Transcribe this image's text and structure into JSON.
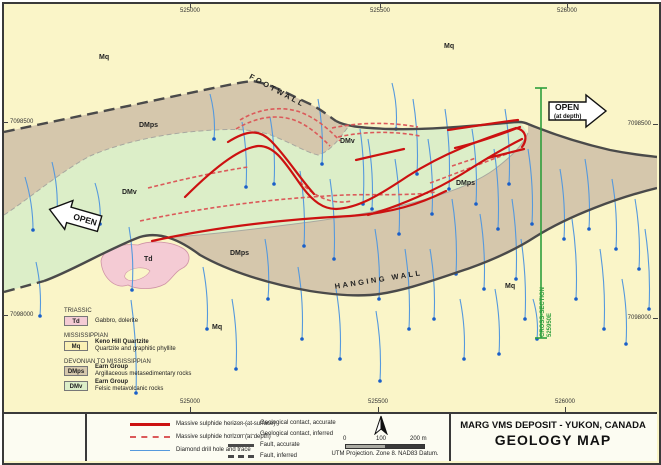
{
  "colors": {
    "mq": "#FAF5C8",
    "dmps": "#D5C7AC",
    "dmv": "#DCEEC8",
    "td": "#F4CBD4",
    "sulphide_red": "#CC1111",
    "sulphide_red_dashed": "#DB5A5A",
    "drill_blue": "#5599DD",
    "drill_dot_blue": "#1A5FC8",
    "fault_gray": "#4A4A4A",
    "contact_gray": "#A8A8A0",
    "section_green": "#2E9E3C"
  },
  "title_block": {
    "line1": "MARG VMS DEPOSIT - YUKON, CANADA",
    "line2": "GEOLOGY MAP"
  },
  "scale_bar": {
    "tick0": "0",
    "tick100": "100",
    "tick200": "200 m",
    "note": "UTM Projection. Zone 8. NAD83 Datum."
  },
  "line_legend": {
    "col1": [
      {
        "label": "Massive sulphide horizon (at surface)",
        "sym": "red-solid"
      },
      {
        "label": "Massive sulphide horizon (at depth)",
        "sym": "red-dashed"
      },
      {
        "label": "Diamond drill hole and trace",
        "sym": "blue-line"
      }
    ],
    "col2": [
      {
        "label": "Geological contact, accurate",
        "sym": "gray-line"
      },
      {
        "label": "Geological contact, inferred",
        "sym": "gray-dashed"
      },
      {
        "label": "Fault, accurate",
        "sym": "fault-line"
      },
      {
        "label": "Fault, inferred",
        "sym": "fault-dashed"
      }
    ]
  },
  "strat_legend": {
    "eras": [
      {
        "era": "TRIASSIC",
        "units": [
          {
            "code": "Td",
            "swatch": "td",
            "name": "",
            "desc": "Gabbro, dolerite"
          }
        ]
      },
      {
        "era": "MISSISSIPPIAN",
        "units": [
          {
            "code": "Mq",
            "swatch": "mq",
            "name": "Keno Hill Quartzite",
            "desc": "Quartzite and graphitic phyllite"
          }
        ]
      },
      {
        "era": "DEVONIAN TO MISSISSIPPIAN",
        "units": [
          {
            "code": "DMps",
            "swatch": "dmps",
            "name": "Earn Group",
            "desc": "Argillaceous metasedimentary rocks"
          },
          {
            "code": "DMv",
            "swatch": "dmv",
            "name": "Earn Group",
            "desc": "Felsic metavolcanic rocks"
          }
        ]
      }
    ]
  },
  "axis": {
    "top_eastings": [
      {
        "label": "525000",
        "x": 190
      },
      {
        "label": "525500",
        "x": 380
      },
      {
        "label": "526000",
        "x": 567
      }
    ],
    "bottom_eastings": [
      {
        "label": "525000",
        "x": 190
      },
      {
        "label": "525500",
        "x": 378
      },
      {
        "label": "526000",
        "x": 565
      }
    ],
    "left_northings": [
      {
        "label": "7098500",
        "y": 122
      },
      {
        "label": "7098000",
        "y": 315
      }
    ],
    "right_northings": [
      {
        "label": "7098500",
        "y": 124
      },
      {
        "label": "7098000",
        "y": 318
      }
    ]
  },
  "map_labels": [
    {
      "t": "Mq",
      "x": 99,
      "y": 54,
      "c": "unit"
    },
    {
      "t": "Mq",
      "x": 444,
      "y": 43,
      "c": "unit"
    },
    {
      "t": "Mq",
      "x": 212,
      "y": 324,
      "c": "unit"
    },
    {
      "t": "Mq",
      "x": 505,
      "y": 283,
      "c": "unit"
    },
    {
      "t": "DMps",
      "x": 139,
      "y": 122,
      "c": "unit"
    },
    {
      "t": "DMps",
      "x": 230,
      "y": 250,
      "c": "unit"
    },
    {
      "t": "DMps",
      "x": 456,
      "y": 180,
      "c": "unit"
    },
    {
      "t": "DMv",
      "x": 122,
      "y": 189,
      "c": "unit"
    },
    {
      "t": "DMv",
      "x": 340,
      "y": 138,
      "c": "unit"
    },
    {
      "t": "Td",
      "x": 144,
      "y": 256,
      "c": "unit"
    },
    {
      "t": "FOOTWALL",
      "x": 252,
      "y": 72,
      "r": 28,
      "c": "wall"
    },
    {
      "t": "HANGING WALL",
      "x": 334,
      "y": 282,
      "r": -9,
      "c": "wall"
    }
  ],
  "annotations": {
    "open_left": "OPEN",
    "open_right1": "OPEN",
    "open_right2": "(at depth)",
    "cross_section1": "CROSS-SECTION",
    "cross_section2": "525950E"
  },
  "drillholes": [
    [
      25,
      177,
      33,
      230
    ],
    [
      52,
      162,
      57,
      214
    ],
    [
      95,
      183,
      100,
      224
    ],
    [
      129,
      227,
      132,
      290
    ],
    [
      36,
      262,
      40,
      316
    ],
    [
      131,
      300,
      136,
      393
    ],
    [
      210,
      94,
      214,
      139
    ],
    [
      242,
      122,
      246,
      187
    ],
    [
      270,
      117,
      274,
      184
    ],
    [
      318,
      99,
      322,
      164
    ],
    [
      203,
      267,
      207,
      329
    ],
    [
      232,
      299,
      236,
      369
    ],
    [
      265,
      239,
      268,
      299
    ],
    [
      300,
      171,
      304,
      246
    ],
    [
      298,
      267,
      302,
      339
    ],
    [
      330,
      179,
      334,
      259
    ],
    [
      336,
      289,
      340,
      359
    ],
    [
      360,
      129,
      363,
      204
    ],
    [
      368,
      139,
      372,
      209
    ],
    [
      375,
      229,
      379,
      299
    ],
    [
      392,
      83,
      396,
      129
    ],
    [
      395,
      159,
      399,
      234
    ],
    [
      405,
      249,
      409,
      329
    ],
    [
      376,
      311,
      380,
      381
    ],
    [
      413,
      99,
      417,
      174
    ],
    [
      428,
      139,
      432,
      214
    ],
    [
      430,
      249,
      434,
      319
    ],
    [
      445,
      109,
      449,
      189
    ],
    [
      452,
      199,
      456,
      274
    ],
    [
      460,
      299,
      464,
      359
    ],
    [
      472,
      129,
      476,
      204
    ],
    [
      480,
      214,
      484,
      289
    ],
    [
      494,
      149,
      498,
      229
    ],
    [
      495,
      289,
      499,
      354
    ],
    [
      505,
      109,
      509,
      184
    ],
    [
      512,
      199,
      516,
      279
    ],
    [
      521,
      239,
      525,
      319
    ],
    [
      528,
      149,
      532,
      224
    ],
    [
      533,
      299,
      537,
      339
    ],
    [
      560,
      169,
      564,
      239
    ],
    [
      572,
      219,
      576,
      299
    ],
    [
      585,
      159,
      589,
      229
    ],
    [
      600,
      249,
      604,
      329
    ],
    [
      612,
      179,
      616,
      249
    ],
    [
      622,
      279,
      626,
      344
    ],
    [
      635,
      199,
      639,
      269
    ],
    [
      645,
      229,
      649,
      309
    ]
  ]
}
